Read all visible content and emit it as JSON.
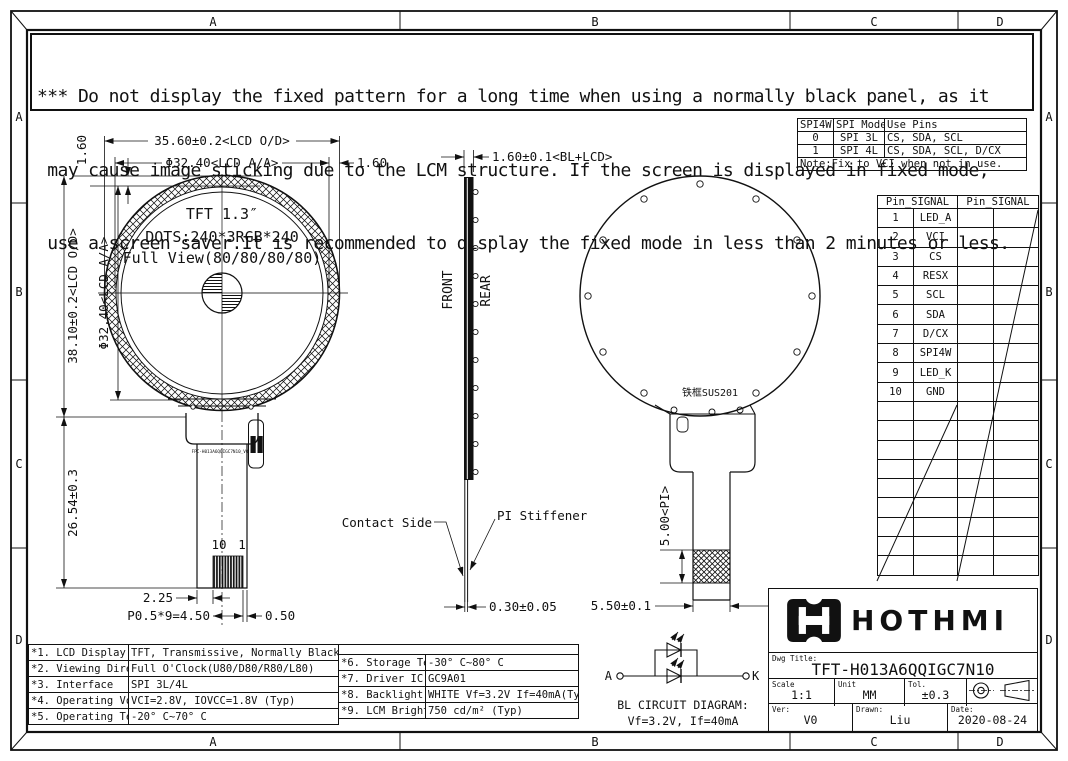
{
  "zones": {
    "cols": [
      "A",
      "B",
      "C",
      "D"
    ],
    "rows": [
      "A",
      "B",
      "C",
      "D"
    ]
  },
  "warning": {
    "lines": [
      "*** Do not display the fixed pattern for a long time when using a normally black panel, as it",
      " may cause image sticking due to the LCM structure. If the screen is displayed in fixed mode,",
      " use a screen saver.It is recommended to display the fixed mode in less than 2 minutes or less."
    ]
  },
  "front_view": {
    "title": "TFT 1.3″",
    "dots": "DOTS:240*3RGB*240",
    "view": "Full View(80/80/80/80)",
    "dim_width_od": "35.60±0.2<LCD O/D>",
    "dim_width_aa": "Φ32.40<LCD A/A>",
    "dim_gap_top": "1.60",
    "dim_gap_right": "1.60",
    "dim_height_od": "38.10±0.2<LCD O/D>",
    "dim_height_aa": "Φ32.40<LCD A/A>",
    "dim_fpc_length": "26.54±0.3",
    "dim_pad_left": "2.25",
    "dim_pitch": "P0.5*9=4.50",
    "dim_pad_right": "0.50",
    "pin_no_first": "10",
    "pin_no_last": "1",
    "fpc_marking": "FPC-H013A6QQIGC7N10_V0"
  },
  "side_view": {
    "front_label": "FRONT",
    "rear_label": "REAR",
    "dim_thickness": "1.60±0.1<BL+LCD>",
    "contact_label": "Contact Side",
    "stiffener_label": "PI Stiffener",
    "dim_fpc_thickness": "0.30±0.05"
  },
  "rear_view": {
    "frame_label": "铁框SUS201",
    "dim_pi": "5.00<PI>",
    "dim_tail_width": "5.50±0.1"
  },
  "bl_circuit": {
    "anode": "A",
    "cathode": "K",
    "line1": "BL CIRCUIT DIAGRAM:",
    "line2": "Vf=3.2V, If=40mA"
  },
  "spi_table": {
    "col1": "SPI4W",
    "col2": "SPI Mode",
    "col3": "Use Pins",
    "rows": [
      [
        "0",
        "SPI 3L",
        "CS, SDA, SCL"
      ],
      [
        "1",
        "SPI 4L",
        "CS, SDA, SCL, D/CX"
      ]
    ],
    "note": "Note:Fix to VCI when not in use."
  },
  "pin_table": {
    "header_left": "Pin_SIGNAL",
    "header_right": "Pin_SIGNAL",
    "pins": [
      {
        "no": "1",
        "signal": "LED_A"
      },
      {
        "no": "2",
        "signal": "VCI"
      },
      {
        "no": "3",
        "signal": "CS"
      },
      {
        "no": "4",
        "signal": "RESX"
      },
      {
        "no": "5",
        "signal": "SCL"
      },
      {
        "no": "6",
        "signal": "SDA"
      },
      {
        "no": "7",
        "signal": "D/CX"
      },
      {
        "no": "8",
        "signal": "SPI4W"
      },
      {
        "no": "9",
        "signal": "LED_K"
      },
      {
        "no": "10",
        "signal": "GND"
      }
    ]
  },
  "spec_table": {
    "rows_left": [
      {
        "name": "*1. LCD Display Type",
        "value": "TFT, Transmissive, Normally Black"
      },
      {
        "name": "*2. Viewing Diretion",
        "value": "Full O'Clock(U80/D80/R80/L80)"
      },
      {
        "name": "*3. Interface",
        "value": "SPI 3L/4L"
      },
      {
        "name": "*4. Operating Voltage",
        "value": "VCI=2.8V, IOVCC=1.8V (Typ)"
      },
      {
        "name": "*5. Operating Temp",
        "value": "-20° C~70° C"
      }
    ],
    "rows_right": [
      {
        "name": "*6. Storage Temp",
        "value": "-30° C~80° C"
      },
      {
        "name": "*7. Driver IC",
        "value": "GC9A01"
      },
      {
        "name": "*8. Backlight",
        "value": "WHITE Vf=3.2V If=40mA(Typ)"
      },
      {
        "name": "*9. LCM Brightness",
        "value": "750 cd/m² (Typ)"
      }
    ]
  },
  "title_block": {
    "brand": "HOTHMI",
    "dwg_title_label": "Dwg Title:",
    "dwg_title": "TFT-H013A6QQIGC7N10",
    "scale_label": "Scale",
    "scale_value": "1:1",
    "unit_label": "Unit",
    "unit_value": "MM",
    "tol_label": "Tol.",
    "tol_value": "±0.3",
    "ver_label": "Ver:",
    "ver_value": "V0",
    "drawn_label": "Drawn:",
    "drawn_value": "Liu",
    "date_label": "Date:",
    "date_value": "2020-08-24"
  }
}
